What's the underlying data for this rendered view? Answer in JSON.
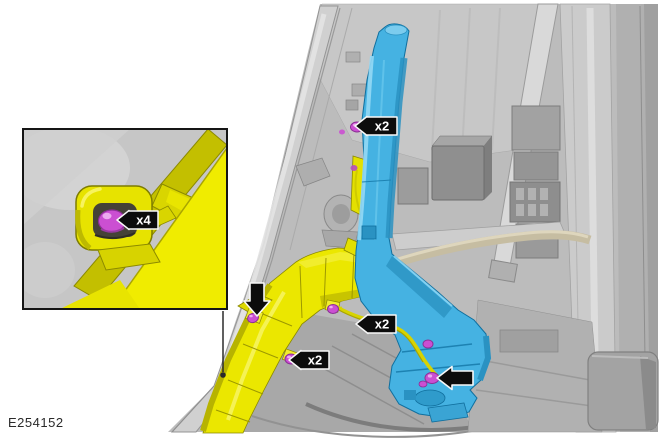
{
  "figure": {
    "id": "E254152"
  },
  "callouts": {
    "inset_x4": {
      "label": "x4"
    },
    "upper_x2": {
      "label": "x2"
    },
    "mid_x2": {
      "label": "x2"
    },
    "lower_x2": {
      "label": "x2"
    }
  },
  "colors": {
    "highlight_yellow": "#ebe700",
    "highlight_blue": "#45b2e2",
    "fastener_magenta": "#cb4fd2",
    "callout_black": "#0c0c0c",
    "callout_outline": "#f8f8f8",
    "background_gray": "#bcbcbc",
    "page_white": "#ffffff"
  }
}
